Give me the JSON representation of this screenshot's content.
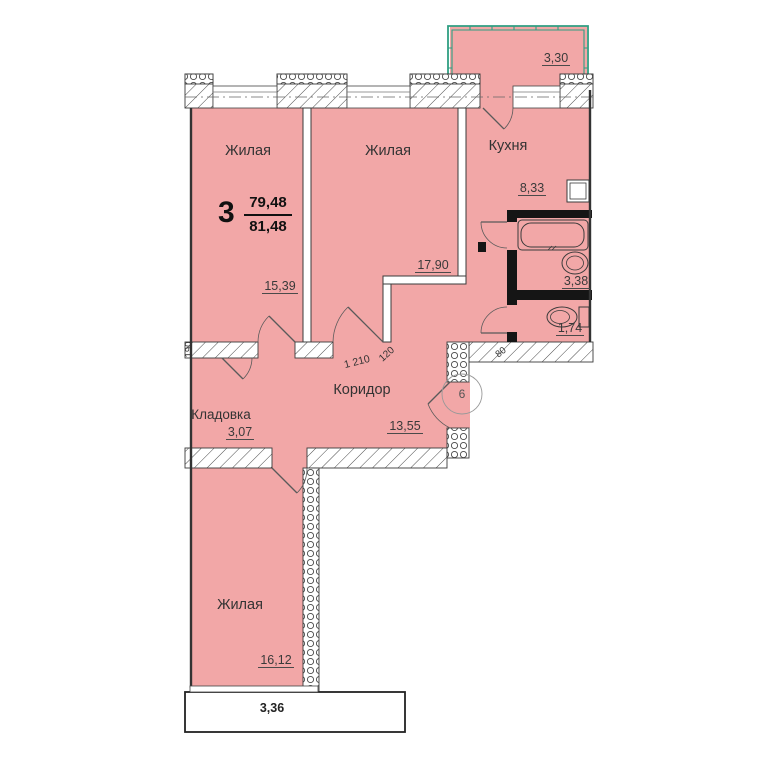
{
  "apartment": {
    "rooms_count": "3",
    "living_area": "79,48",
    "total_area": "81,48"
  },
  "entrance": {
    "number": "6"
  },
  "rooms": {
    "living1": {
      "label": "Жилая",
      "area": "15,39"
    },
    "living2": {
      "label": "Жилая",
      "area": "17,90"
    },
    "kitchen": {
      "label": "Кухня",
      "area": "8,33"
    },
    "corridor": {
      "label": "Коридор",
      "area": "13,55"
    },
    "storage": {
      "label": "Кладовка",
      "area": "3,07"
    },
    "living3": {
      "label": "Жилая",
      "area": "16,12"
    },
    "bathroom": {
      "area": "3,38"
    },
    "toilet": {
      "area": "1,74"
    },
    "balcony_top": {
      "area": "3,30"
    },
    "balcony_bottom": {
      "area": "3,36"
    }
  },
  "dimensions": {
    "storage_wall": "190",
    "corridor_opening": "1 210",
    "door_width": "120",
    "entry_wall": "80"
  },
  "colors": {
    "room_fill": "#f2a7a7",
    "balcony_rail": "#2f9e82",
    "wall_black": "#151515"
  }
}
